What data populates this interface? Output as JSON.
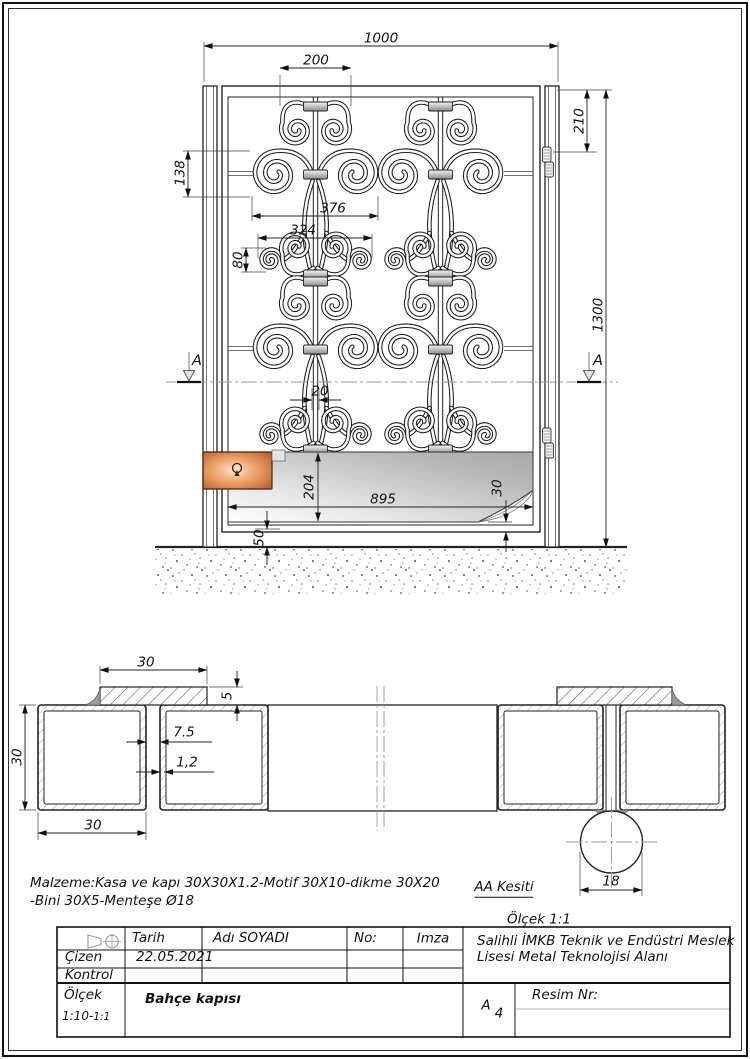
{
  "front_view": {
    "dims": {
      "width_total": "1000",
      "motif_top_width": "200",
      "hinge_offset": "210",
      "height_total": "1300",
      "scroll_height": "138",
      "motif_width": "376",
      "small_scroll_width": "324",
      "small_scroll_height": "80",
      "leg_gap": "20",
      "panel_height": "204",
      "panel_width": "895",
      "panel_bottom_offset": "30",
      "ground_clearance": "50"
    },
    "section_marker": "A"
  },
  "section_view": {
    "dims": {
      "bini_width": "30",
      "bini_thickness": "5",
      "tube_height": "30",
      "frame_gap": "7.5",
      "wall_thickness": "1,2",
      "tube_width": "30",
      "hinge_diameter": "18"
    },
    "label": "AA Kesiti",
    "scale_note": "Ölçek 1:1"
  },
  "notes": {
    "line1": "Malzeme:Kasa ve kapı 30X30X1.2-Motif 30X10-dikme 30X20",
    "line2": "-Bini 30X5-Menteşe Ø18"
  },
  "title_block": {
    "tarih_label": "Tarih",
    "adi_label": "Adı SOYADI",
    "no_label": "No:",
    "imza_label": "Imza",
    "cizen_label": "Çizen",
    "kontrol_label": "Kontrol",
    "tarih_value": "22.05.2021",
    "olcek_label": "Ölçek",
    "olcek_value": "1:10-",
    "olcek_value_small": "1:1",
    "drawing_title": "Bahçe kapısı",
    "school_line1": "Salihli İMKB Teknik ve Endüstri Meslek",
    "school_line2": "Lisesi Metal Teknolojisi Alanı",
    "paper_size": "A",
    "paper_size_sub": "4",
    "resim_label": "Resim Nr:"
  },
  "colors": {
    "lock_accent": "#c0622a",
    "panel_gray": "#b0b0b0",
    "line": "#1a1a1a"
  }
}
